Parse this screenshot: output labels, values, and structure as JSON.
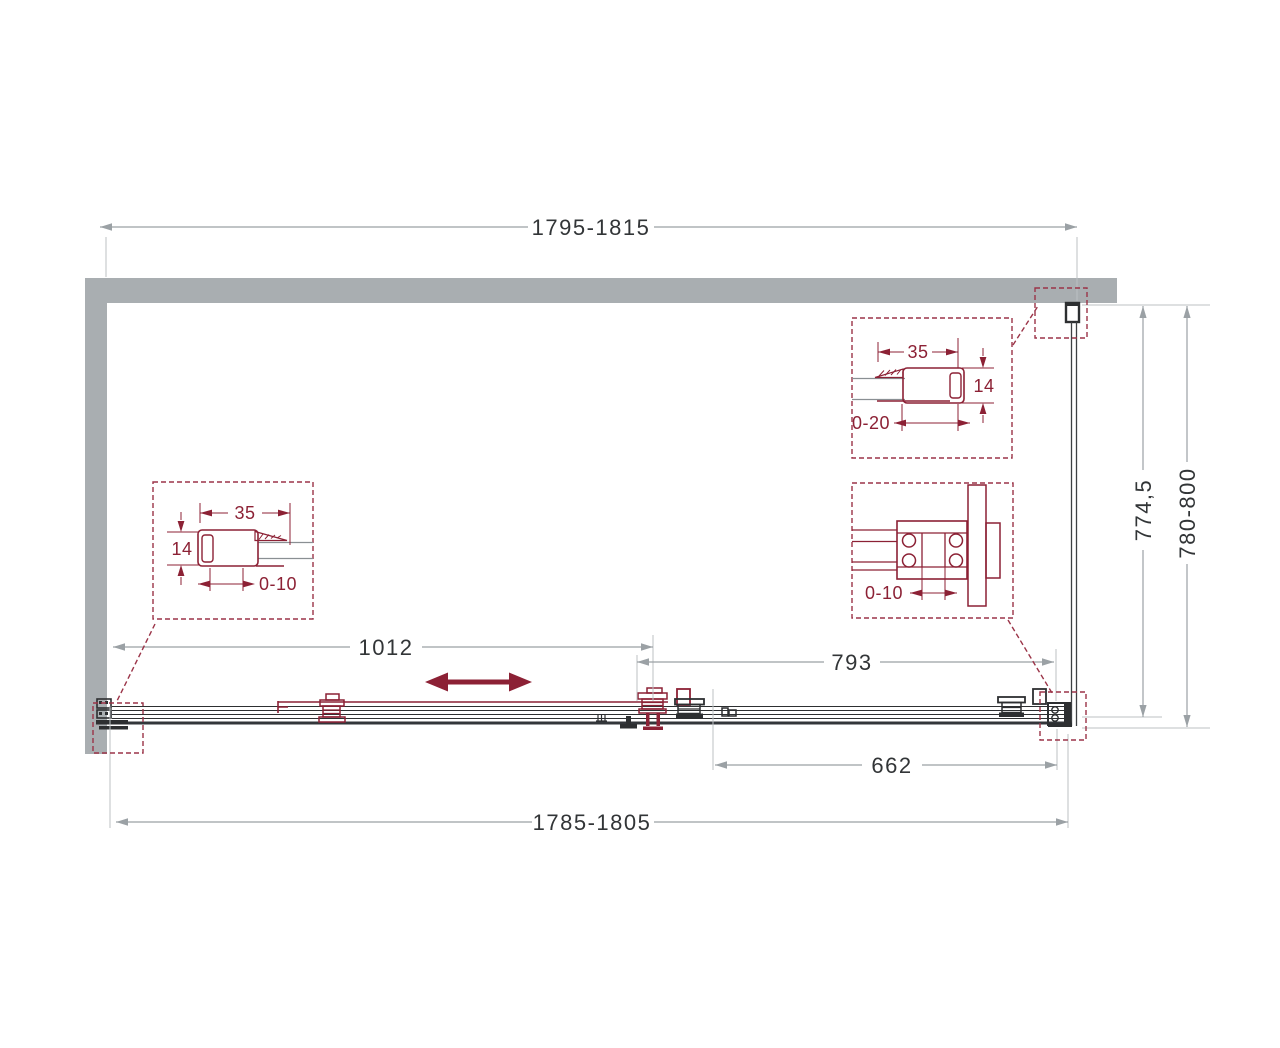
{
  "diagram": {
    "type": "shower-enclosure-plan-drawing",
    "dimensions": {
      "top_width": "1795-1815",
      "bottom_width": "1785-1805",
      "depth": "774,5",
      "depth_range": "780-800",
      "door_width": "1012",
      "fixed_panel_width": "793",
      "opening_width": "662"
    },
    "details": {
      "wall_profile_right": {
        "width": "35",
        "thickness": "14",
        "adjustment": "0-20"
      },
      "wall_profile_left": {
        "width": "35",
        "thickness": "14",
        "adjustment": "0-10"
      },
      "roller_carriage": {
        "adjustment": "0-10"
      }
    },
    "colors": {
      "wall": "#a9aeb1",
      "accent": "#8c2135",
      "callout": "#9b3448",
      "line": "#3d4043",
      "dim_line": "#9ba1a5",
      "dim_text": "#323537"
    }
  }
}
